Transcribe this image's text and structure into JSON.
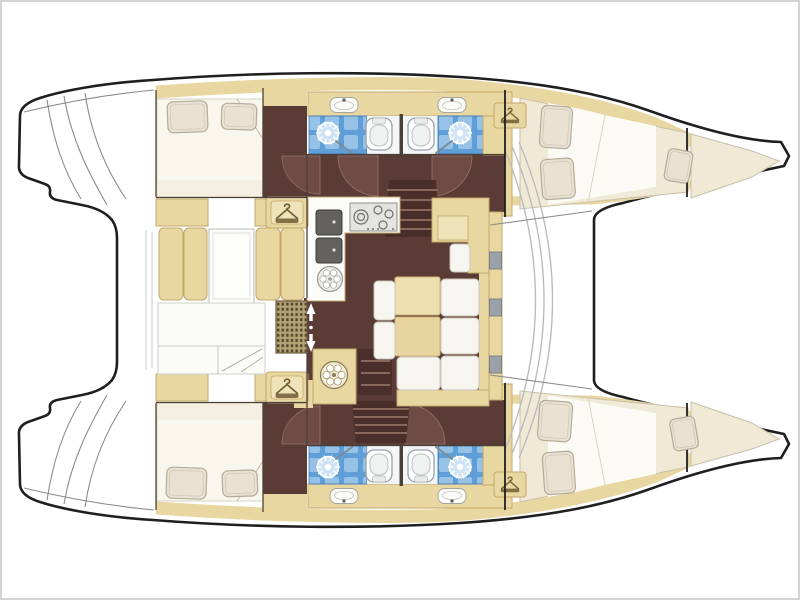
{
  "image": {
    "type": "boat-floor-plan",
    "subject": "sailing catamaran interior layout, top view",
    "bow_direction": "right",
    "background": "#ffffff"
  },
  "palette": {
    "outline": "#1f1f1f",
    "frame": "#d2d2d2",
    "beige": "#e9d7a2",
    "beige-edge": "#c3a86b",
    "beige-light": "#f0e3ba",
    "maroon": "#5a3b36",
    "maroon-dark": "#4a2e2a",
    "tread": "#9c7a6c",
    "arc-fill": "#6f4b45",
    "arc-line": "#95756b",
    "wall": "#4a4038",
    "bed": "#f9f6ee",
    "cream": "#f0e9d6",
    "cream-edge": "#c9c0aa",
    "sheet": "#fbfaf5",
    "pillow": "#e9e2d2",
    "pillow-edge": "#b3ac9a",
    "cushion": "#f7f5ef",
    "bench-white": "#fbfbf8",
    "counter": "#fcfcf9",
    "blue": "#5f9ed6",
    "blue-tile": "#a9cdec",
    "blue-deep": "#3a76b4",
    "bath-white": "#f3f6f8",
    "appliance-face": "#e4e4e2",
    "appliance-edge": "#8e8e8c",
    "sink-dark": "#63625e",
    "sink-edge": "#3c3b38",
    "grate": "#b2a276",
    "grate-hole": "#564428",
    "step-line": "#8c8c8c",
    "window-gray": "#9aa1a8",
    "wand": "#7d8b96",
    "hanger": "#6f5d33"
  },
  "legend": {
    "rooms": [
      {
        "name": "aft-cabin-port",
        "items": [
          "double-bed",
          "two-pillows",
          "wardrobe"
        ]
      },
      {
        "name": "head-port-aft",
        "items": [
          "shower",
          "toilet",
          "washbasin"
        ]
      },
      {
        "name": "head-port-forward",
        "items": [
          "shower",
          "toilet",
          "washbasin"
        ]
      },
      {
        "name": "forward-cabin-port",
        "items": [
          "double-berth",
          "two-pillows",
          "wardrobe"
        ]
      },
      {
        "name": "forepeak-port",
        "items": [
          "single-berth",
          "pillow"
        ]
      },
      {
        "name": "aft-cabin-starboard",
        "items": [
          "double-bed",
          "two-pillows",
          "wardrobe"
        ]
      },
      {
        "name": "head-starboard-aft",
        "items": [
          "shower",
          "toilet",
          "washbasin"
        ]
      },
      {
        "name": "head-starboard-forward",
        "items": [
          "shower",
          "toilet",
          "washbasin"
        ]
      },
      {
        "name": "forward-cabin-starboard",
        "items": [
          "double-berth",
          "two-pillows",
          "wardrobe"
        ]
      },
      {
        "name": "forepeak-starboard",
        "items": [
          "single-berth",
          "pillow"
        ]
      },
      {
        "name": "saloon",
        "items": [
          "galley-l-counter",
          "gas-hob",
          "double-sink",
          "round-appliance",
          "dining-table",
          "u-shaped-settee",
          "nav-seat",
          "companionway-steps",
          "hull-steps"
        ]
      },
      {
        "name": "cockpit",
        "items": [
          "bench-cushions",
          "cockpit-table",
          "aft-bench",
          "deck-grate",
          "sliding-door",
          "washing-machine"
        ]
      },
      {
        "name": "foredeck",
        "items": [
          "trampoline"
        ]
      },
      {
        "name": "transoms",
        "items": [
          "swim-steps-port",
          "swim-steps-starboard"
        ]
      }
    ],
    "icons": [
      "hanger-icon",
      "shower-head-icon",
      "toilet-icon",
      "washbasin-icon",
      "hob-burners-icon",
      "washing-machine-icon",
      "sliding-door-arrows-icon"
    ]
  }
}
